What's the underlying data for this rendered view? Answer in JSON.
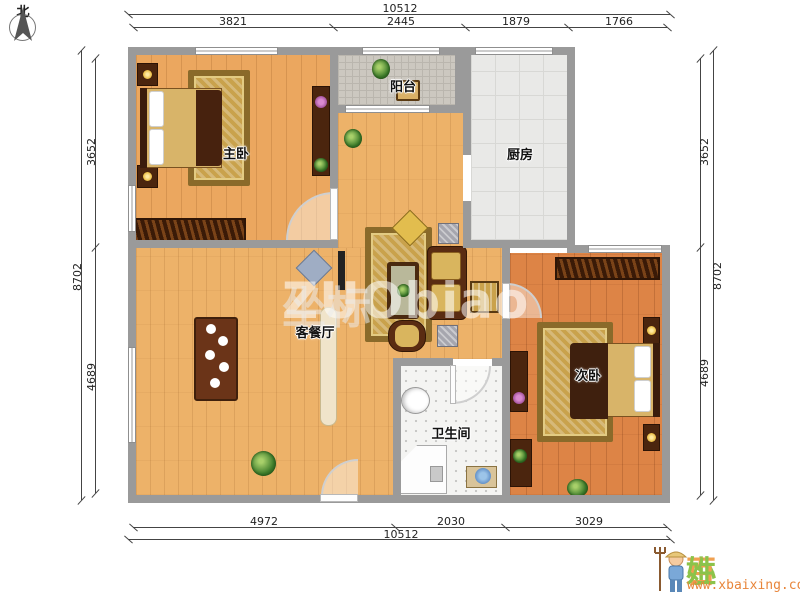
{
  "compass": {
    "north_label": "北"
  },
  "watermark": {
    "latin": "ZUObiao",
    "cn": "坐标"
  },
  "rooms": {
    "master_bedroom": {
      "label": "主卧"
    },
    "balcony": {
      "label": "阳台"
    },
    "kitchen": {
      "label": "厨房"
    },
    "living_dining": {
      "label": "客餐厅"
    },
    "bathroom": {
      "label": "卫生间"
    },
    "second_bedroom": {
      "label": "次卧"
    }
  },
  "dims": {
    "top_total": "10512",
    "top_segments": [
      "3821",
      "2445",
      "1879",
      "1766"
    ],
    "bottom_segments": [
      "4972",
      "2030",
      "3029"
    ],
    "bottom_total": "10512",
    "left_segments": [
      "3652",
      "4689"
    ],
    "left_total": "8702",
    "right_segments": [
      "3652",
      "4689"
    ],
    "right_total": "8702"
  },
  "logo": {
    "brand_char_1": "小",
    "brand_char_2": "百",
    "brand_char_3": "姓",
    "url": "www.xbaixing.com"
  },
  "colors": {
    "wall": "#9a9a9a",
    "floor_master": "#eba75f",
    "floor_living": "#edb269",
    "floor_second": "#dd8446",
    "floor_kitchen": "#e9e9e7",
    "floor_balcony": "#ccc8c0",
    "floor_bath": "#f4f4f2",
    "dark_wood": "#4b250e",
    "rug_gold": "#c9a24c",
    "brand_green": "#8bc34a",
    "brand_orange": "#f0a050"
  }
}
